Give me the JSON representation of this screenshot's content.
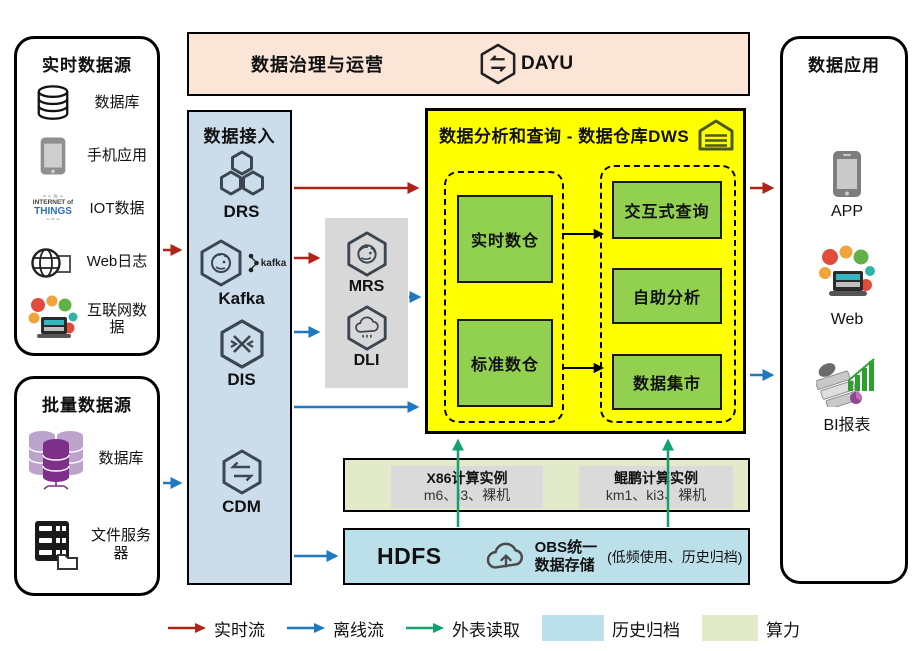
{
  "realtime_sources": {
    "title": "实时数据源",
    "items": [
      {
        "label": "数据库",
        "icon": "database-icon"
      },
      {
        "label": "手机应用",
        "icon": "phone-icon"
      },
      {
        "label": "IOT数据",
        "icon": "iot-wordcloud-icon"
      },
      {
        "label": "Web日志",
        "icon": "web-log-icon"
      },
      {
        "label": "互联网数据",
        "icon": "internet-collage-icon"
      }
    ],
    "iot_words": {
      "line1": "INTERNET of",
      "line2": "THINGS"
    }
  },
  "batch_sources": {
    "title": "批量数据源",
    "items": [
      {
        "label": "数据库",
        "icon": "database-stack-icon"
      },
      {
        "label": "文件服务器",
        "icon": "file-server-icon"
      }
    ]
  },
  "governance": {
    "title": "数据治理与运营",
    "product": "DAYU"
  },
  "ingestion": {
    "title": "数据接入",
    "services": [
      "DRS",
      "Kafka",
      "DIS",
      "CDM"
    ],
    "kafka_logo_text": "kafka"
  },
  "processing": {
    "services": [
      "MRS",
      "DLI"
    ]
  },
  "dws": {
    "title": "数据分析和查询 - 数据仓库DWS",
    "left_group": [
      "实时数仓",
      "标准数仓"
    ],
    "right_group": [
      "交互式查询",
      "自助分析",
      "数据集市"
    ]
  },
  "compute": {
    "x86": {
      "title": "X86计算实例",
      "subtitle": "m6、i3、裸机"
    },
    "kunpeng": {
      "title": "鲲鹏计算实例",
      "subtitle": "km1、ki3、裸机"
    }
  },
  "storage": {
    "hdfs": "HDFS",
    "obs_line1": "OBS统一",
    "obs_line2": "数据存储",
    "note": "(低频使用、历史归档)"
  },
  "applications": {
    "title": "数据应用",
    "items": [
      "APP",
      "Web",
      "BI报表"
    ]
  },
  "legend": {
    "realtime": "实时流",
    "offline": "离线流",
    "external": "外表读取",
    "archive": "历史归档",
    "compute": "算力"
  },
  "colors": {
    "realtime_arrow": "#B02318",
    "offline_arrow": "#1F78C1",
    "external_arrow": "#12A26B",
    "archive_fill": "#BCE0EA",
    "compute_fill": "#E2EACA",
    "dws_fill": "#FFFF00",
    "module_green": "#92D050",
    "ingestion_fill": "#CBDCEB",
    "governance_fill": "#FBE5D6"
  }
}
